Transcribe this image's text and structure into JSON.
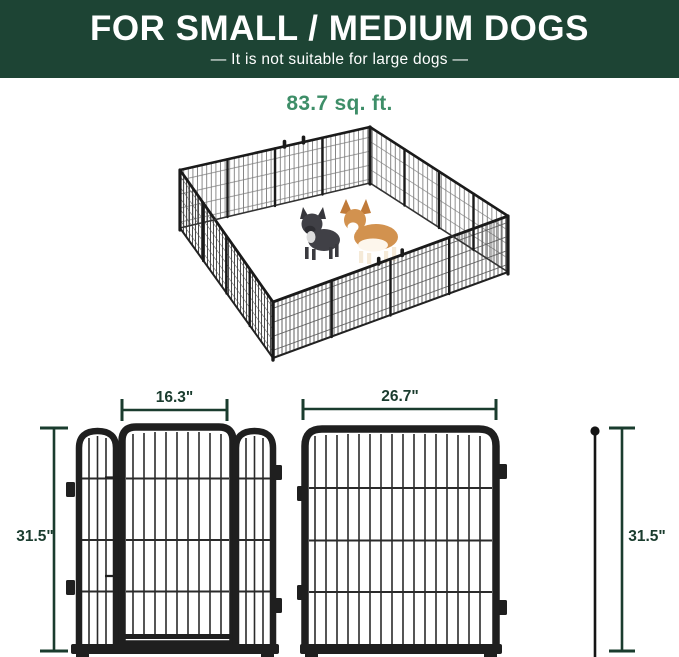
{
  "banner": {
    "title": "FOR SMALL / MEDIUM DOGS",
    "subtitle": "—  It is not suitable for large dogs  —",
    "bg_color": "#1d4434",
    "text_color": "#ffffff"
  },
  "area_label": {
    "text": "83.7 sq. ft.",
    "color": "#3e8e68"
  },
  "illustration": {
    "description": "isometric 16-panel metal wire dog playpen enclosure",
    "dogs": [
      "french-bulldog-illustration",
      "corgi-illustration"
    ],
    "panel_color": "#1f1f1f",
    "floor_color": "#ffffff"
  },
  "dimensions": {
    "unit": "inches",
    "line_color": "#1a3c2e",
    "gate_door_width": "16.3\"",
    "panel_width": "26.7\"",
    "left_height": "31.5\"",
    "right_height": "31.5\""
  }
}
